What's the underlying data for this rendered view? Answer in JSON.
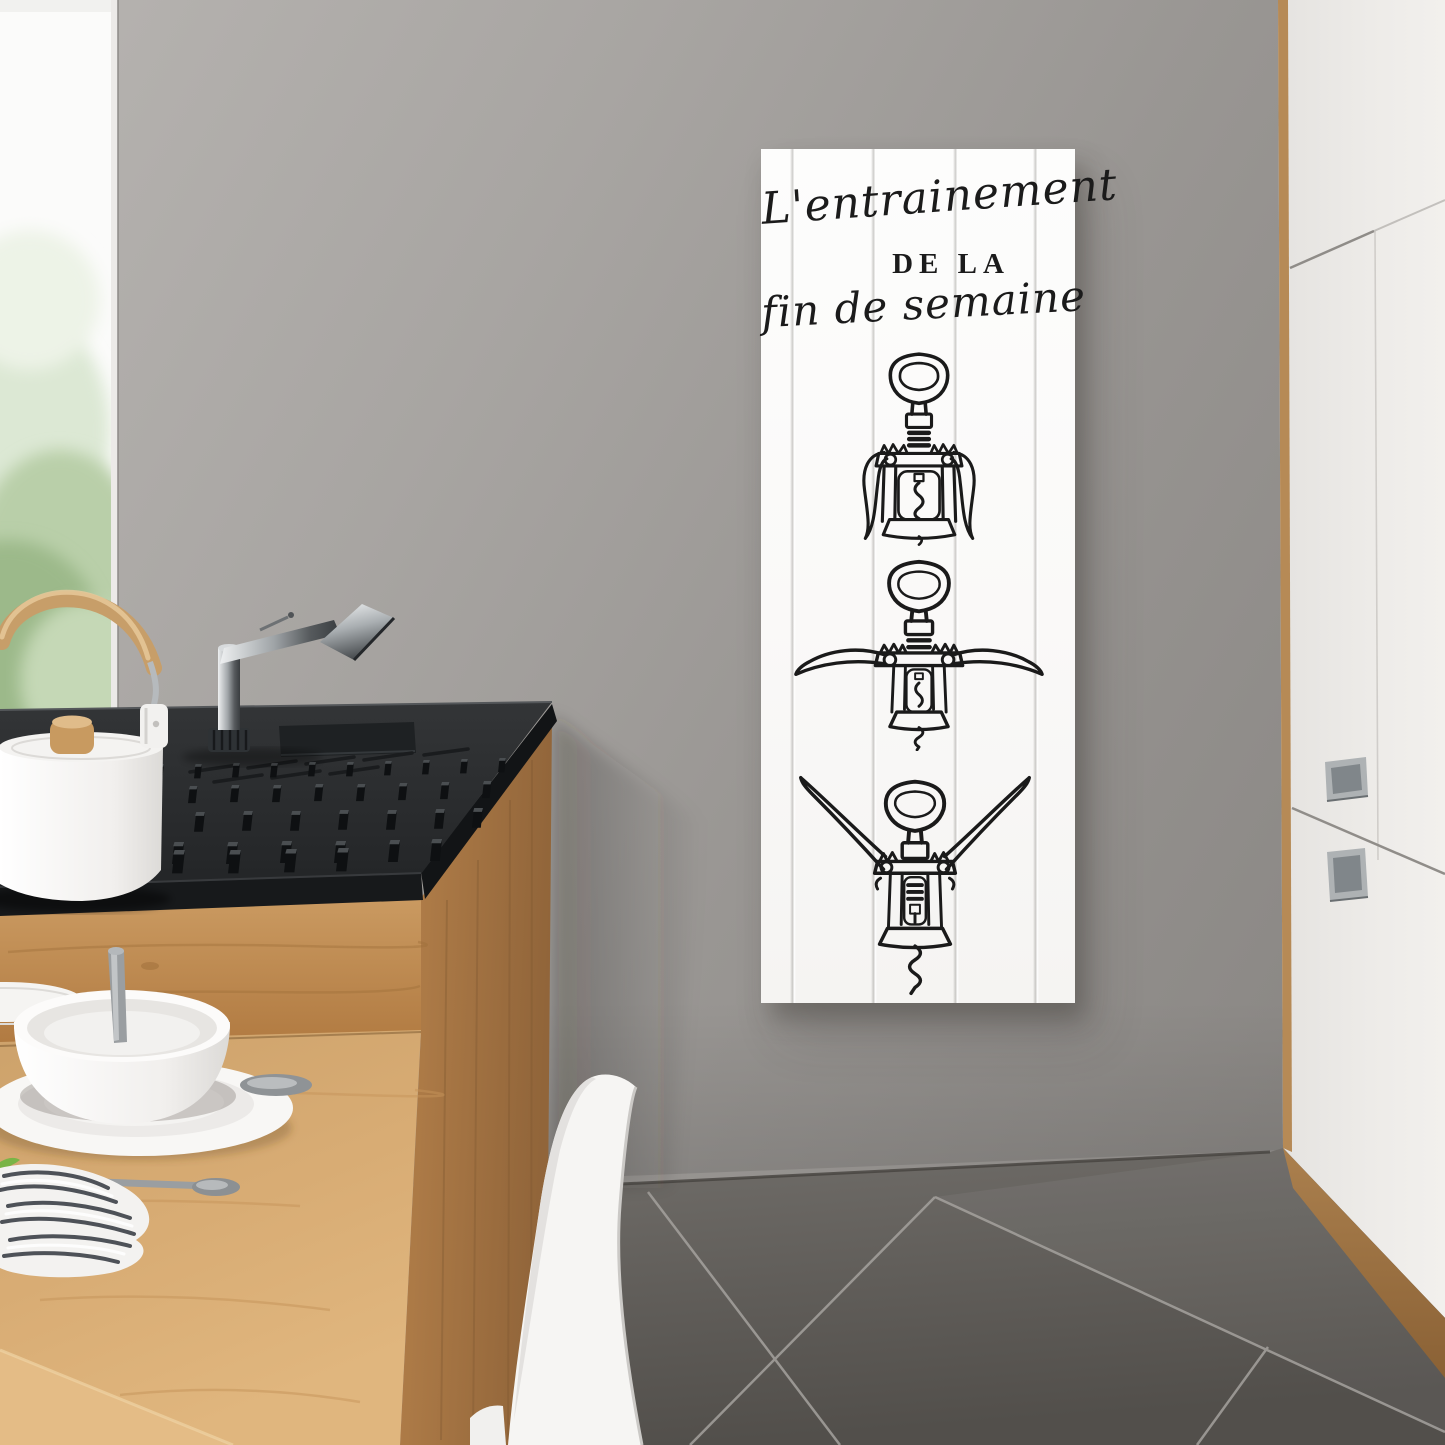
{
  "artwork_sign": {
    "title_line1": "L'entrainement",
    "title_line2": "DE LA",
    "title_line3": "fin de semaine",
    "illustrations": [
      {
        "name": "corkscrew-wings-closed"
      },
      {
        "name": "corkscrew-wings-half-raised"
      },
      {
        "name": "corkscrew-wings-raised-screw-extended"
      }
    ]
  },
  "palette": {
    "wall": "#a3a09d",
    "sign_board": "#fbfaf9",
    "ink": "#1a1a1a",
    "counter_black": "#2c2e30",
    "wood_cabinet": "#c6965e",
    "wood_table": "#d6aa72",
    "cabinet_white": "#edebe8",
    "floor_tile": "#5f5c58",
    "chair_white": "#f6f5f3",
    "greenery": "#a8c297"
  }
}
